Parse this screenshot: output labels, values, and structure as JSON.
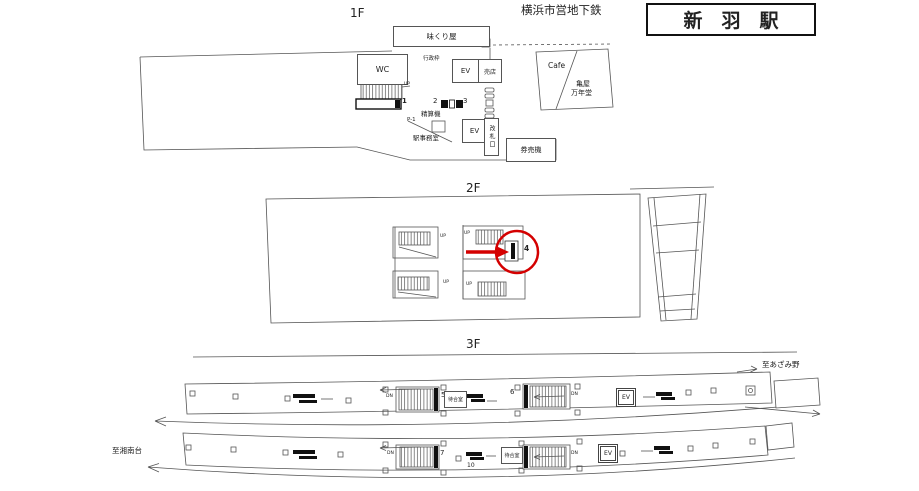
{
  "header": {
    "operator": "横浜市営地下鉄",
    "station_name": "新　羽　駅"
  },
  "f1": {
    "label": "1F",
    "ajikuriya": "味くり屋",
    "wc": "WC",
    "gyosei": "行政枠",
    "ev_upper": "EV",
    "baiten": "売店",
    "cafe": "Cafe",
    "kameya1": "亀屋",
    "kameya2": "万年堂",
    "p1": "P-1",
    "seisanki": "精算機",
    "office": "駅事務室",
    "ev_lower": "EV",
    "kaisatsu": "改札口",
    "kenbaiki": "券売機",
    "up": "UP",
    "pos1": "1",
    "pos2": "2",
    "pos3": "3"
  },
  "f2": {
    "label": "2F",
    "up": "UP",
    "pos4": "4"
  },
  "f3": {
    "label": "3F",
    "to_azamino": "至あざみ野",
    "to_shonandai": "至湘南台",
    "waiting_room": "待合室",
    "ev": "EV",
    "dn": "DN",
    "pos5": "5",
    "pos6": "6",
    "pos7": "7",
    "pos8": "8",
    "pos10": "10"
  },
  "colors": {
    "line": "#555555",
    "ink": "#111111",
    "highlight_red": "#d40000"
  }
}
